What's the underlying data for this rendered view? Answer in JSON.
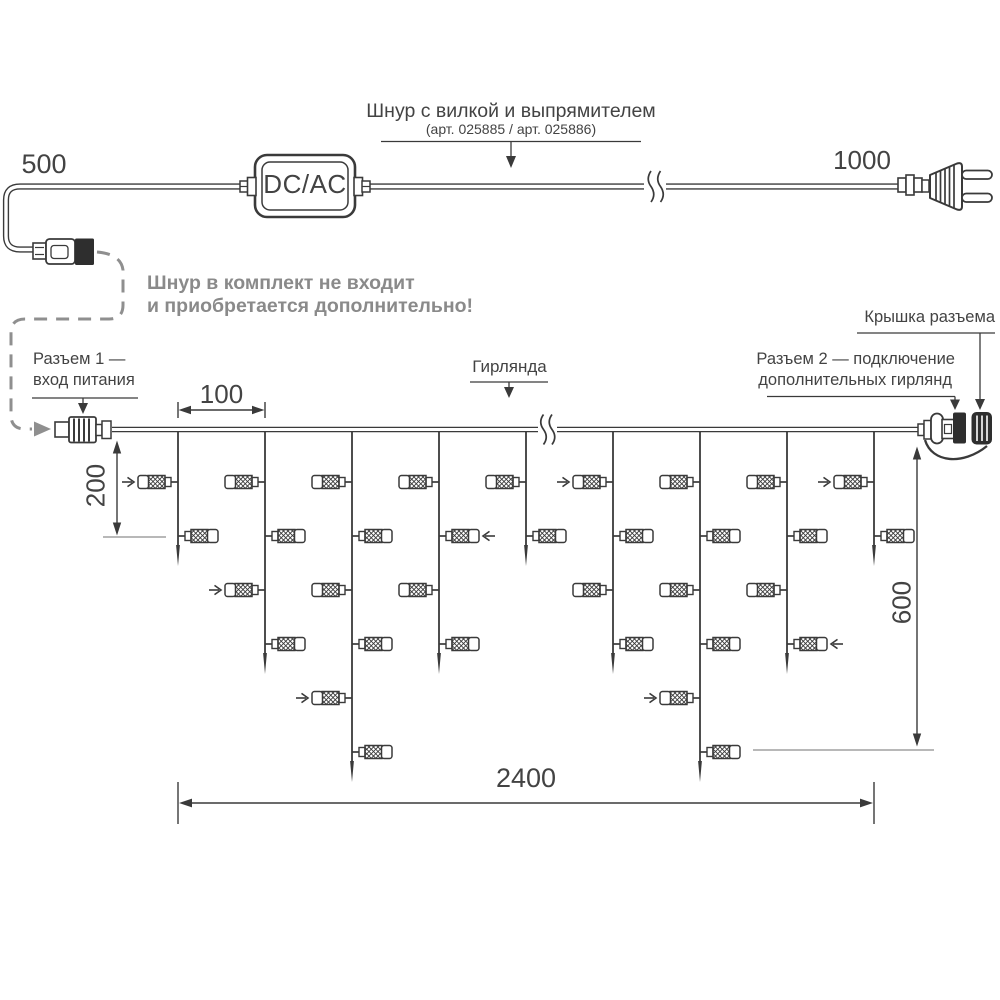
{
  "colors": {
    "ink": "#3a3a3a",
    "text": "#434343",
    "muted_gray": "#8a8a8a",
    "dash_gray": "#8f8f8f",
    "ref_gray": "#a0a0a0",
    "black_fill": "#2e2e2e"
  },
  "top_diagram": {
    "left_length": "500",
    "right_length": "1000",
    "converter_label": "DC/AC",
    "cord_label": "Шнур с вилкой и выпрямителем",
    "cord_label_sub": "(арт. 025885 / арт. 025886)",
    "note_line1": "Шнур в комплект не входит",
    "note_line2": "и приобретается дополнительно!"
  },
  "garland_diagram": {
    "connector1_label_line1": "Разъем 1 —",
    "connector1_label_line2": "вход питания",
    "garland_label": "Гирлянда",
    "connector2_label_line1": "Разъем 2 — подключение",
    "connector2_label_line2": "дополнительных гирлянд",
    "cap_label": "Крышка разъема",
    "dims": {
      "drop_spacing": "100",
      "first_drop_height": "200",
      "max_height": "600",
      "total_length": "2400"
    },
    "wire_y": 429.5,
    "row_start_y": 482,
    "row_step": 54,
    "drops": [
      {
        "x": 178,
        "lights": 2,
        "arrow_rows": [
          1
        ]
      },
      {
        "x": 265,
        "lights": 4,
        "arrow_rows": [
          3
        ]
      },
      {
        "x": 352,
        "lights": 6,
        "arrow_rows": [
          5
        ]
      },
      {
        "x": 439,
        "lights": 4,
        "arrow_rows": [
          2
        ]
      },
      {
        "x": 526,
        "lights": 2,
        "arrow_rows": []
      },
      {
        "x": 613,
        "lights": 4,
        "arrow_rows": [
          1
        ]
      },
      {
        "x": 700,
        "lights": 6,
        "arrow_rows": [
          5
        ]
      },
      {
        "x": 787,
        "lights": 4,
        "arrow_rows": [
          4
        ]
      },
      {
        "x": 874,
        "lights": 2,
        "arrow_rows": [
          1
        ]
      }
    ]
  }
}
